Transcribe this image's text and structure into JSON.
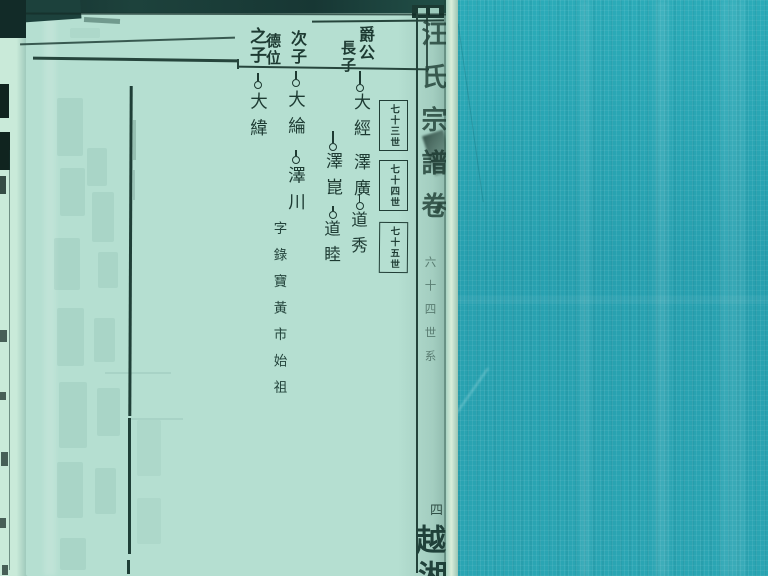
{
  "colors": {
    "fabric_teal": "#29a4b2",
    "page_green": "#b5dfd1",
    "ink": "#1d3a32",
    "underpage": "#c3e6d8",
    "top_shadow": "#16332f"
  },
  "header": {
    "eldest_parent": "爵公",
    "eldest_label": "長子",
    "second_label": "次子",
    "third_parent": "德位",
    "third_label": "之子"
  },
  "generation_labels": [
    "七十三世",
    "七十四世",
    "七十五世"
  ],
  "tree": {
    "branch1": {
      "gen1": "大經",
      "gen2": "澤廣",
      "gen3": "道秀"
    },
    "branch2": {
      "gen2": "澤崑",
      "gen3": "道睦"
    },
    "branch3": {
      "gen1": "大綸",
      "gen2": "澤川",
      "note": "字錄寶黃市始祖"
    },
    "branch4": {
      "gen1": "大緯"
    }
  },
  "spine": {
    "title": "汪氏宗譜卷",
    "small_text": "六十四世系",
    "bottom_mark": "四",
    "bottom_char1": "越",
    "bottom_char2": "湘"
  }
}
